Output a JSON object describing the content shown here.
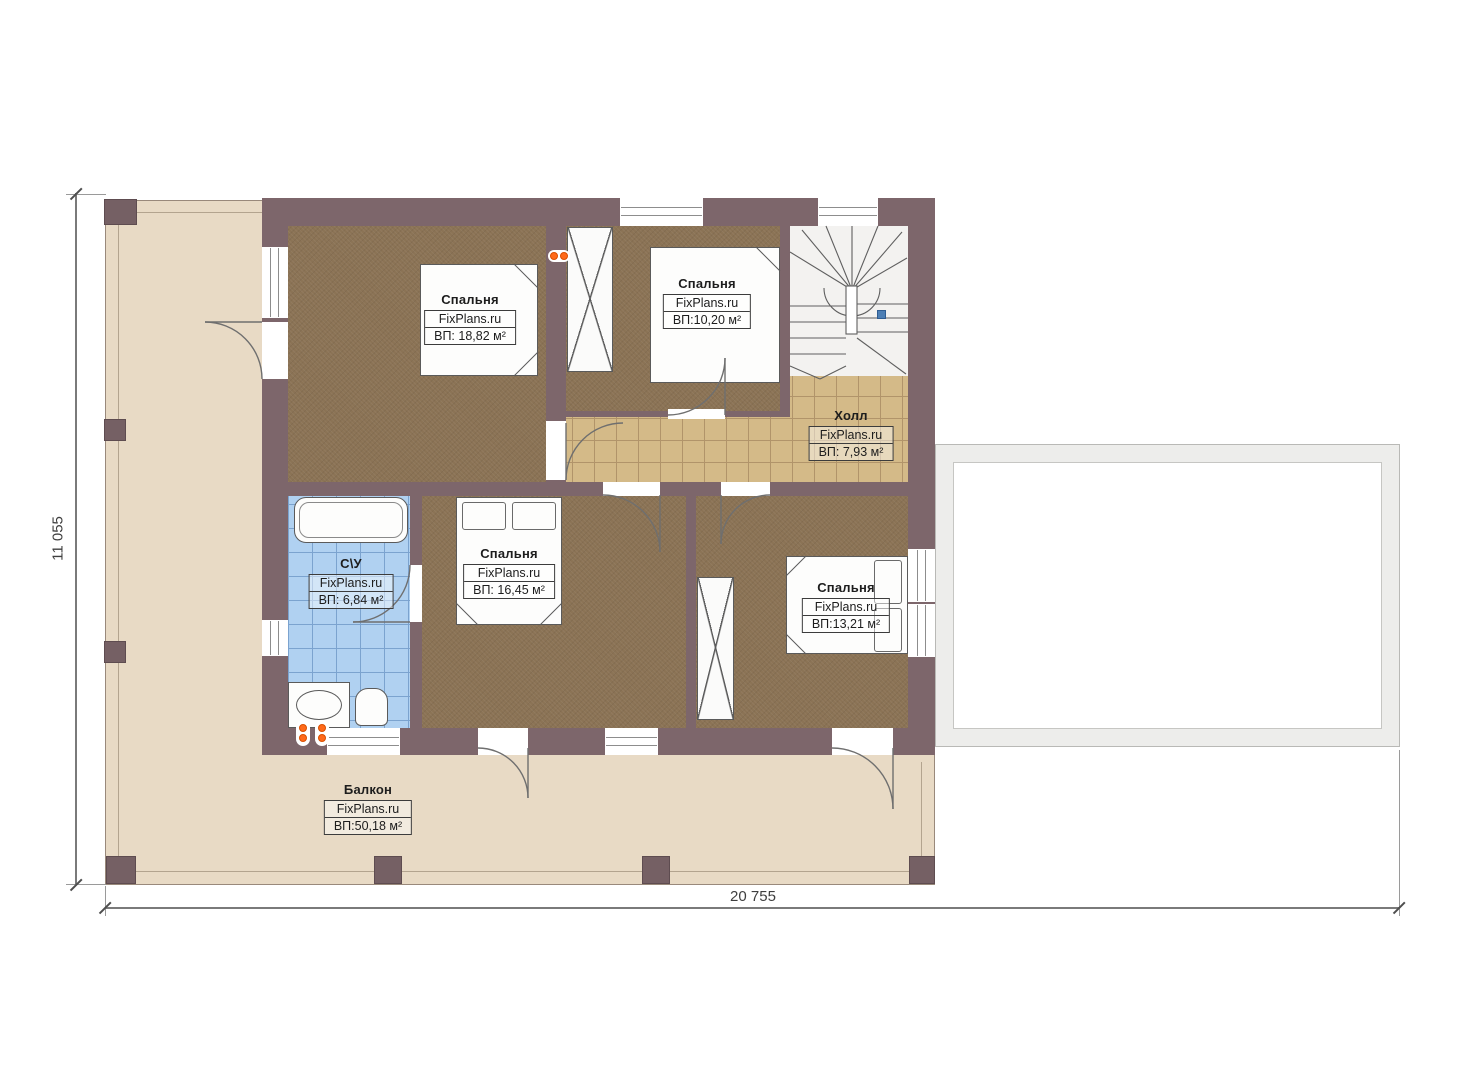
{
  "rooms": {
    "bedroom1": {
      "name": "Спальня",
      "brand": "FixPlans.ru",
      "area": "ВП: 18,82 м²"
    },
    "bedroom2": {
      "name": "Спальня",
      "brand": "FixPlans.ru",
      "area": "ВП:10,20 м²"
    },
    "hall": {
      "name": "Холл",
      "brand": "FixPlans.ru",
      "area": "ВП: 7,93 м²"
    },
    "bathroom": {
      "name": "С\\У",
      "brand": "FixPlans.ru",
      "area": "ВП: 6,84 м²"
    },
    "bedroom3": {
      "name": "Спальня",
      "brand": "FixPlans.ru",
      "area": "ВП: 16,45 м²"
    },
    "bedroom4": {
      "name": "Спальня",
      "brand": "FixPlans.ru",
      "area": "ВП:13,21 м²"
    },
    "balcony": {
      "name": "Балкон",
      "brand": "FixPlans.ru",
      "area": "ВП:50,18 м²"
    }
  },
  "dimensions": {
    "bottom": "20 755",
    "left": "11 055"
  },
  "colors": {
    "wall": "#7d666b",
    "bedroom_floor": "#8b7355",
    "hall_tile": "#d4ba88",
    "bathroom_tile": "#b0d1f1",
    "terrace_floor": "#e8dac5",
    "roof_outline_fill": "#ededeb",
    "socket_orange": "#ff6a1a",
    "stair_marker_blue": "#4d7fb5"
  }
}
